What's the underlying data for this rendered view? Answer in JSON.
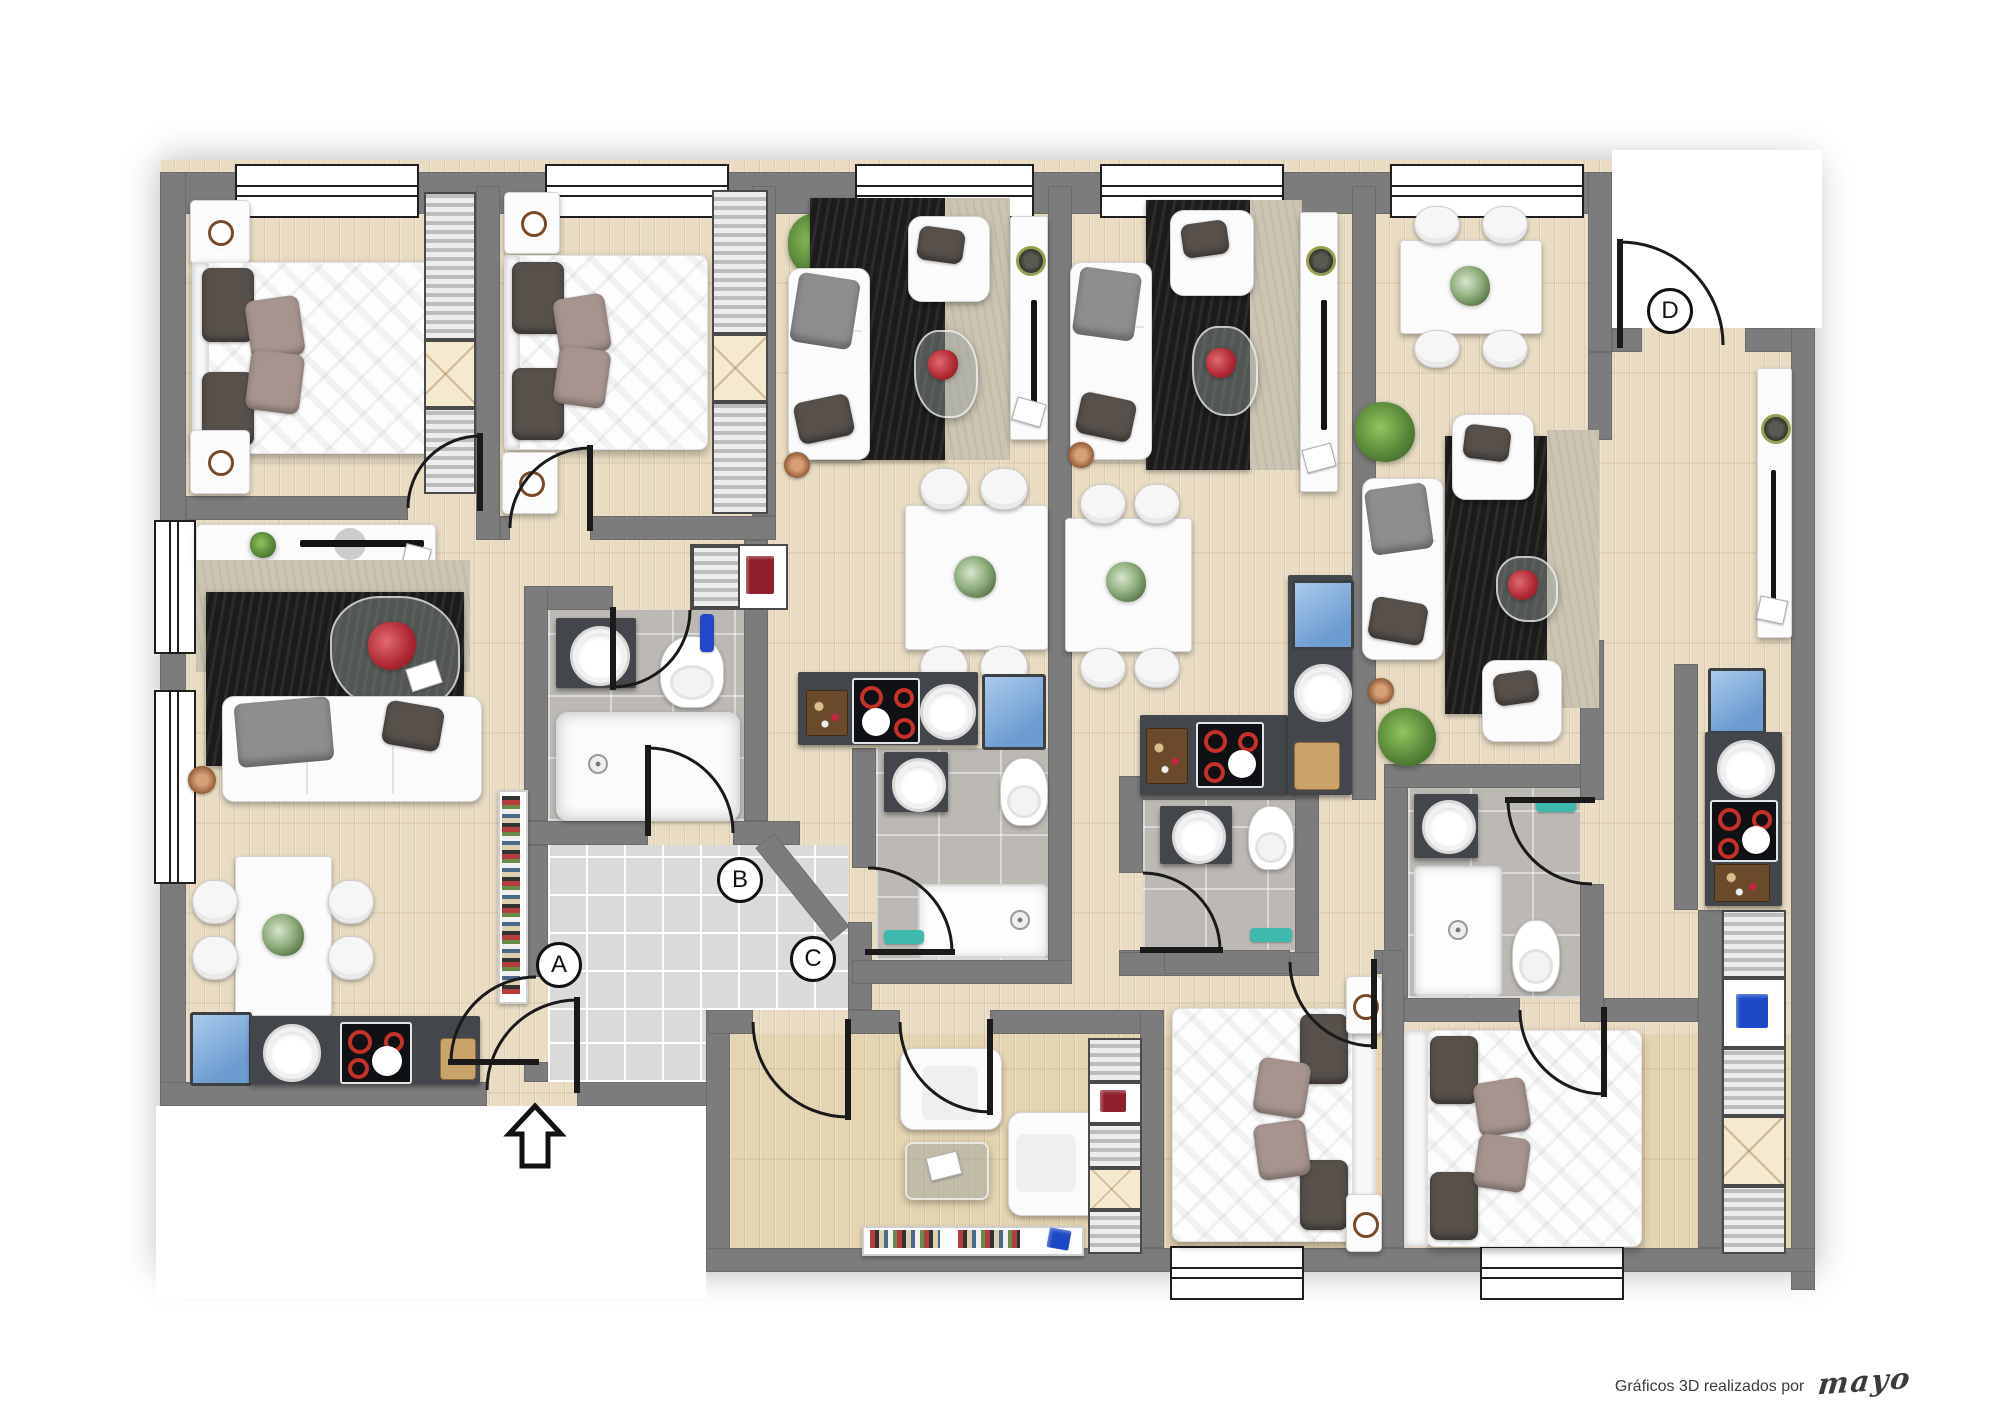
{
  "page": {
    "background": "#ffffff",
    "credit": {
      "text": "Gráficos 3D realizados por",
      "signature": "mayo"
    }
  },
  "plan": {
    "type": "apartment-floor-plan",
    "style": "3d-rendered-top-view",
    "entrance_labels": {
      "a": "A",
      "b": "B",
      "c": "C",
      "d": "D"
    },
    "building_entrance_arrow": "up",
    "palette": {
      "wall": "#7c7c7c",
      "wood_floor": "#e9dcc3",
      "corridor_tile": "#dadada",
      "bathroom_tile": "#bcb9b5",
      "rug_dark": "#1d1c1b",
      "rug_light": "#cbc4b2",
      "furniture_white": "#fbfbfb",
      "counter_dark": "#43464a",
      "hob_ring_red": "#c53028",
      "fridge_blue": "#6d9cd1",
      "plant_green": "#59893a",
      "pillow_dark": "#57504b",
      "pillow_taupe": "#a7948f"
    },
    "units": [
      {
        "id": "A",
        "rooms": [
          "bedroom",
          "living-dining",
          "kitchen",
          "bathroom"
        ]
      },
      {
        "id": "B",
        "rooms": [
          "bedroom",
          "living-dining",
          "kitchen",
          "bathroom",
          "closet"
        ]
      },
      {
        "id": "C",
        "rooms": [
          "lounge",
          "bedroom",
          "living-dining",
          "kitchen",
          "bathroom"
        ]
      },
      {
        "id": "D",
        "rooms": [
          "entry",
          "dining",
          "living",
          "kitchen",
          "bathroom",
          "bedroom"
        ]
      }
    ],
    "furniture_glossary": [
      "double-bed",
      "nightstand",
      "wardrobe",
      "sofa",
      "armchair",
      "loveseat",
      "coffee-table",
      "dining-table",
      "dining-chair",
      "tv-sideboard",
      "bookshelf",
      "floor-lamp",
      "plant",
      "flower-bouquet",
      "fridge",
      "sink",
      "induction-hob",
      "cutting-board",
      "toilet",
      "washbasin",
      "bathtub",
      "shower",
      "towel",
      "rug"
    ]
  }
}
